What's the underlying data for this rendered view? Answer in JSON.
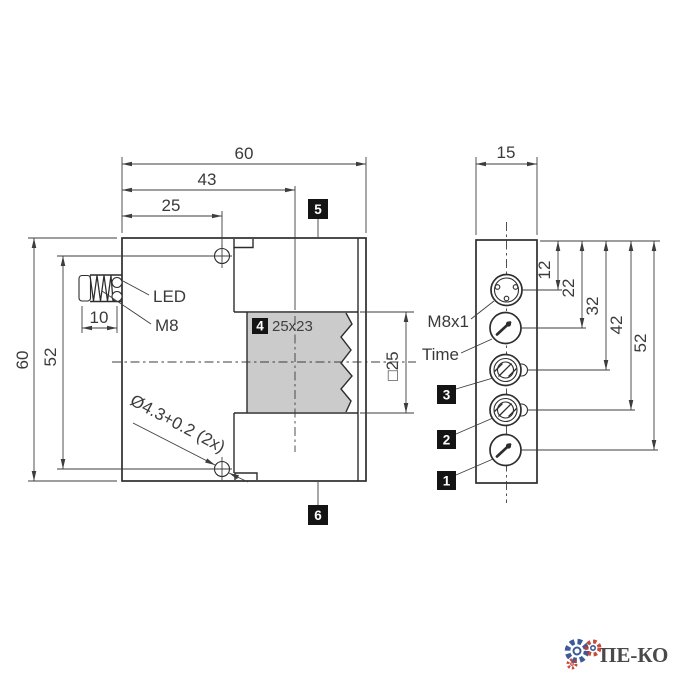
{
  "drawing": {
    "front": {
      "dim_width_total": "60",
      "dim_width_head": "43",
      "dim_hole_x": "25",
      "dim_height_total": "60",
      "dim_hole_spacing": "52",
      "dim_connector_len": "10",
      "label_led": "LED",
      "label_m8": "M8",
      "label_holes": "Ø4.3+0.2 (2x)",
      "label_window": "25x23",
      "label_window_square": "□25",
      "marker_4": "4",
      "marker_5": "5",
      "marker_6": "6"
    },
    "side": {
      "dim_depth": "15",
      "label_connector": "M8x1",
      "label_time": "Time",
      "marker_3": "3",
      "marker_2": "2",
      "marker_1": "1",
      "dim_connector_pos": "12",
      "dim_time_pos": "22",
      "dim_led3_pos": "32",
      "dim_led2_pos": "42",
      "dim_pot1_pos": "52"
    },
    "watermark": {
      "text": "ПЕ-КО",
      "color": "#2a4d8f",
      "accent": "#c23b2e"
    },
    "colors": {
      "line": "#2d2d2d",
      "window_fill": "#cbcbcb",
      "badge_bg": "#141414"
    }
  }
}
